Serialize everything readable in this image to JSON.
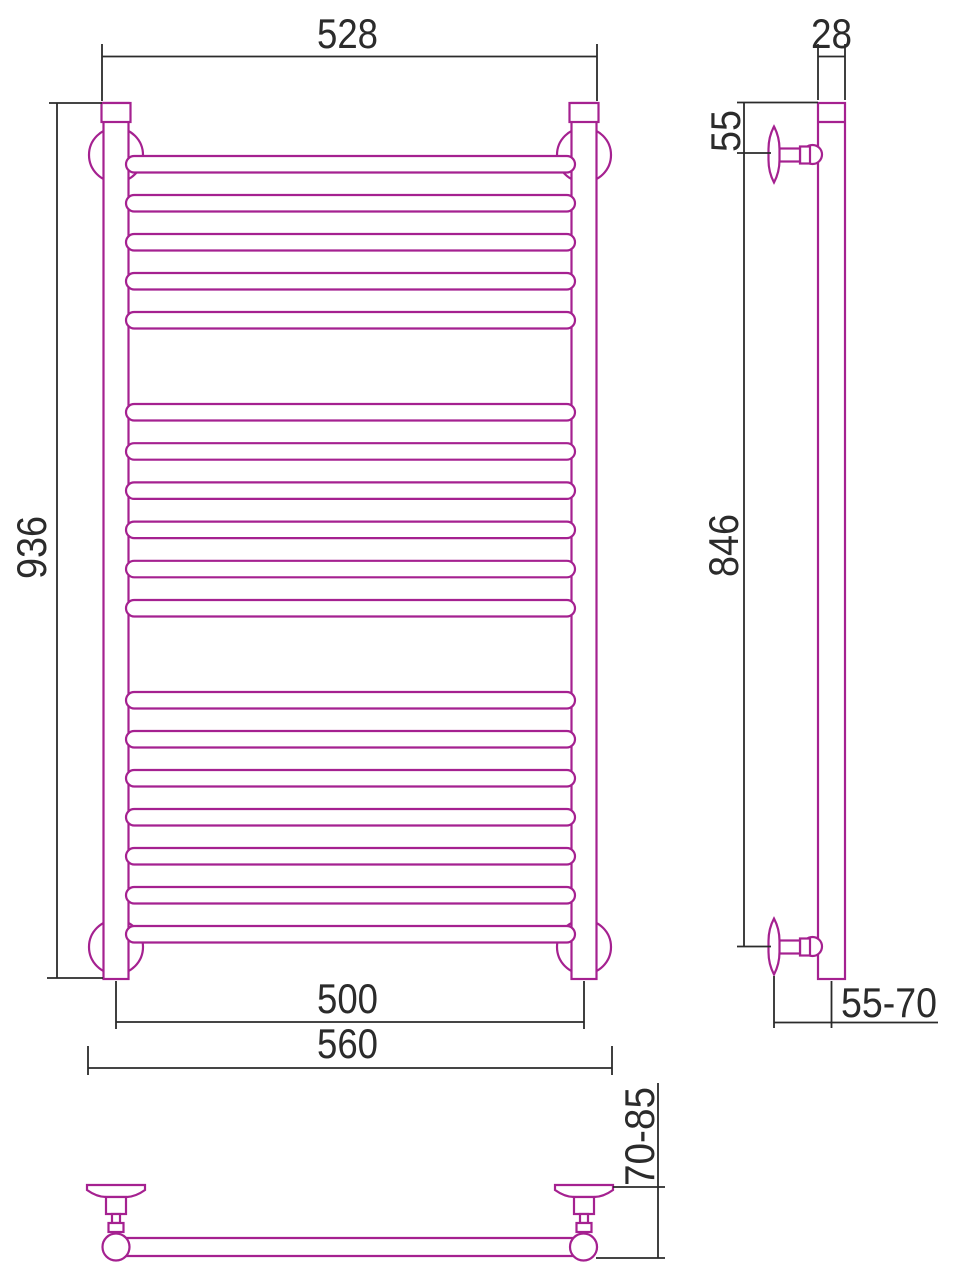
{
  "colors": {
    "component": "#A52190",
    "dimension_lines": "#2B2B2B",
    "text": "#2B2B2B",
    "background": "#FFFFFF"
  },
  "views": {
    "front": {
      "name": "front view of ladder towel rail",
      "rung_groups": [
        5,
        6,
        7
      ],
      "rungs_total": 18,
      "dimensions": {
        "top_width": "528",
        "height": "936",
        "bracket_centers_width": "500",
        "overall_width": "560"
      }
    },
    "side": {
      "name": "side view",
      "dimensions": {
        "tube_depth": "28",
        "top_to_bracket": "55",
        "bracket_span": "846",
        "wall_to_axis": "55-70"
      }
    },
    "plan": {
      "name": "bottom view",
      "dimensions": {
        "wall_to_front": "70-85"
      }
    }
  }
}
